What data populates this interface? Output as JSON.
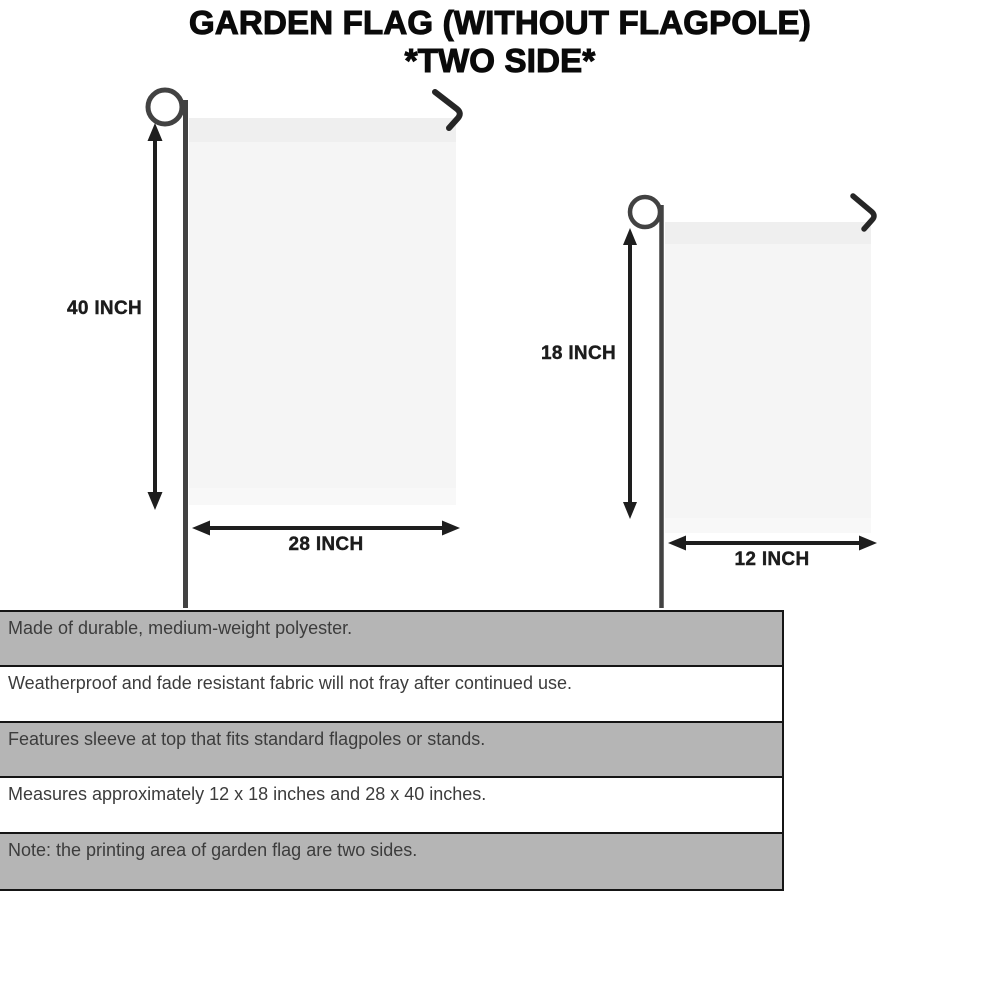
{
  "title": {
    "line1": "GARDEN FLAG (WITHOUT FLAGPOLE)",
    "line2": "*TWO SIDE*"
  },
  "flags": {
    "large": {
      "height_label": "40 INCH",
      "width_label": "28 INCH"
    },
    "small": {
      "height_label": "18 INCH",
      "width_label": "12 INCH"
    }
  },
  "features": [
    {
      "text": "Made of durable, medium-weight polyester."
    },
    {
      "text": "Weatherproof and fade resistant fabric will not fray after continued use."
    },
    {
      "text": "Features sleeve at top that fits standard flagpoles or stands."
    },
    {
      "text": "Measures approximately 12 x 18 inches and 28 x 40 inches."
    },
    {
      "text": "Note: the printing area of garden flag are two sides."
    }
  ],
  "colors": {
    "row_shaded": "#b5b5b5",
    "row_plain": "#ffffff",
    "panel_border": "#151515",
    "flag_fill": "#f5f5f5",
    "flag_sleeve": "#efefef",
    "pole": "#424242",
    "arrow": "#1e1e1e",
    "feature_text": "#3c3c3c",
    "title_text": "#0a0a0a"
  }
}
